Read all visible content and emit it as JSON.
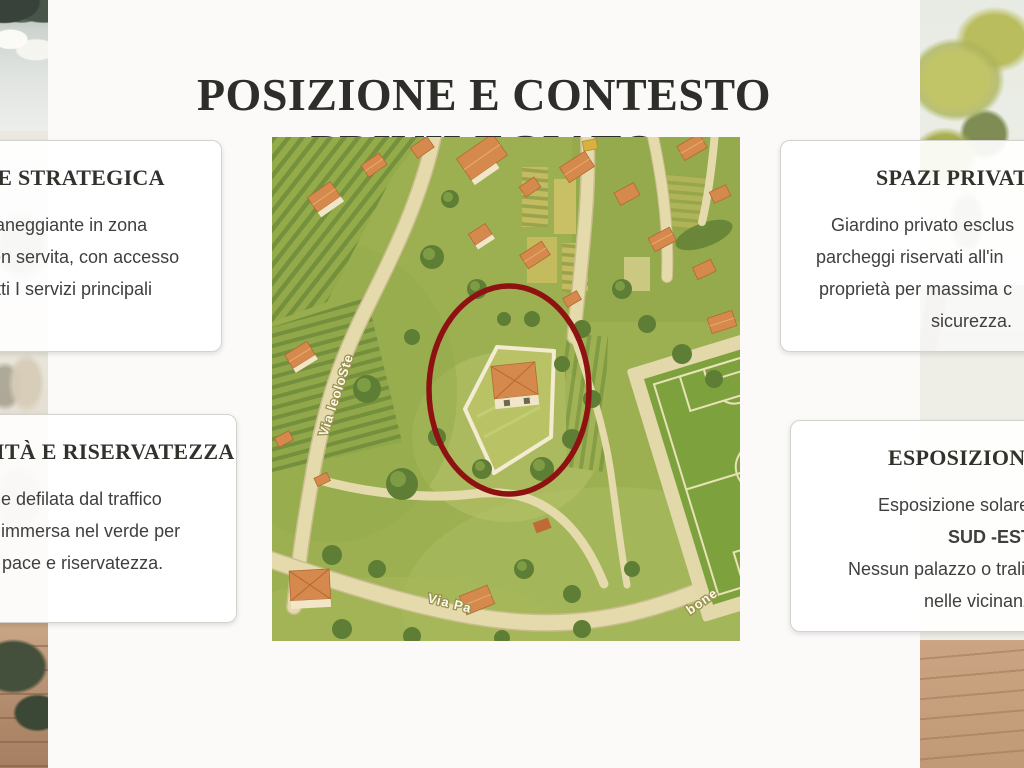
{
  "slide": {
    "title": "POSIZIONE E CONTESTO PRIVILEGIATO"
  },
  "cards": {
    "strategic": {
      "heading": "NE STRATEGICA",
      "lines": [
        "pianeggiante in zona",
        "ben servita, con accesso",
        "tutti I servizi principali"
      ]
    },
    "privacy": {
      "heading": "LITÀ E RISERVATEZZA",
      "lines": [
        "one defilata dal traffico",
        "a, immersa nel verde per",
        "re pace e riservatezza."
      ]
    },
    "spaces": {
      "heading": "SPAZI PRIVAT",
      "lines": [
        "Giardino privato esclus",
        "parcheggi riservati all'in",
        "proprietà per massima c",
        "sicurezza."
      ]
    },
    "exposure": {
      "heading": "ESPOSIZION",
      "lines": [
        "Esposizione solare",
        "SUD -EST",
        "Nessun palazzo o trali",
        "nelle vicinanz"
      ]
    }
  },
  "map": {
    "road_labels": {
      "left": "Via leoloSte",
      "bottom_left": "Via Pa",
      "bottom_right": "bone"
    },
    "highlight_color": "#8e1212"
  },
  "colors": {
    "page_bg": "#fbfaf9",
    "title": "#2d2d29",
    "heading": "#32322d",
    "body_text": "#3f3f3f",
    "card_border": "#d3d2cc",
    "map_green": "#9cb052",
    "road_cream": "#e4daab",
    "roof_orange": "#d6894c"
  }
}
